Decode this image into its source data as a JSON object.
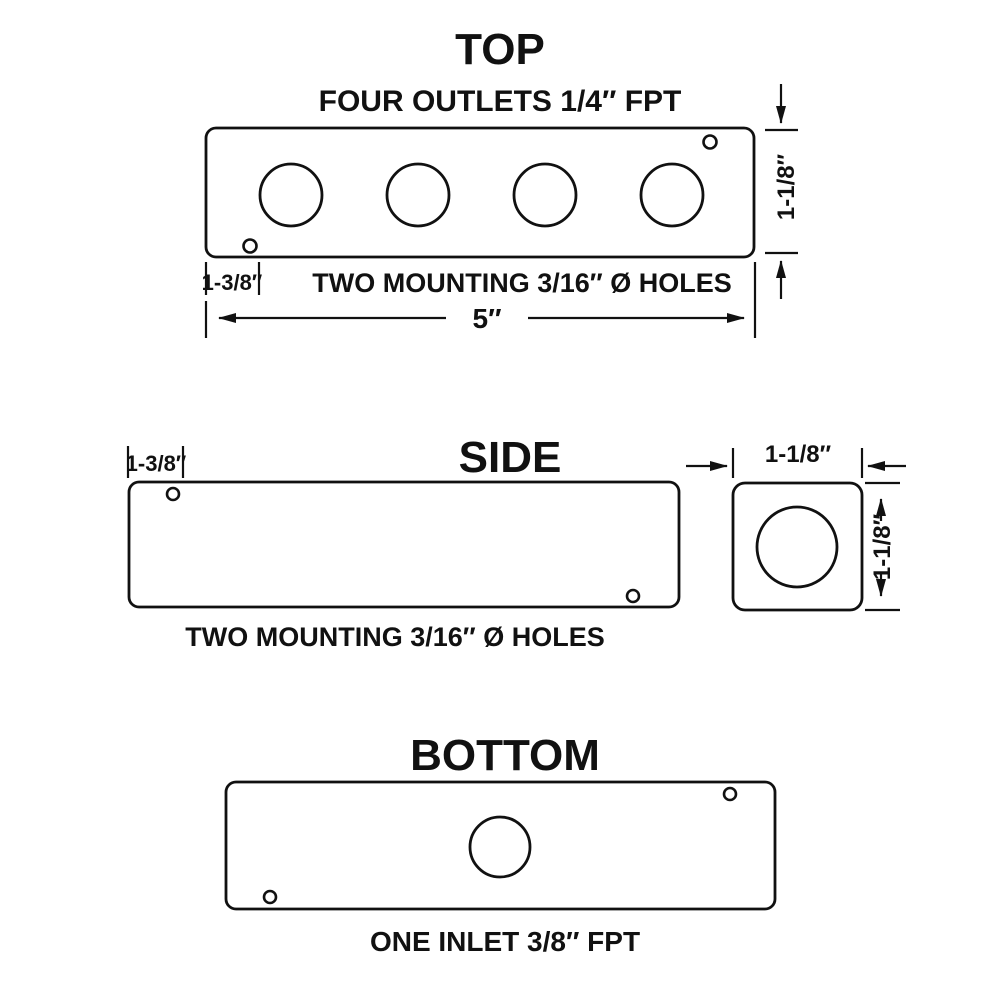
{
  "drawing": {
    "colors": {
      "line": "#111111",
      "background": "#ffffff"
    },
    "top_view": {
      "title": "TOP",
      "subtitle": "FOUR OUTLETS 1/4″ FPT",
      "mounting_note": "TWO MOUNTING 3/16″ Ø HOLES",
      "width_dim": "5″",
      "height_dim": "1-1/8″",
      "hole_offset_dim": "1-3/8″",
      "outlet_count": 4,
      "mounting_hole_count": 2
    },
    "side_view": {
      "title": "SIDE",
      "mounting_note": "TWO MOUNTING 3/16″ Ø HOLES",
      "hole_offset_dim": "1-3/8″",
      "mounting_hole_count": 2
    },
    "end_view": {
      "width_dim": "1-1/8″",
      "height_dim": "1-1/8″"
    },
    "bottom_view": {
      "title": "BOTTOM",
      "inlet_note": "ONE INLET 3/8″ FPT",
      "mounting_hole_count": 2
    }
  }
}
